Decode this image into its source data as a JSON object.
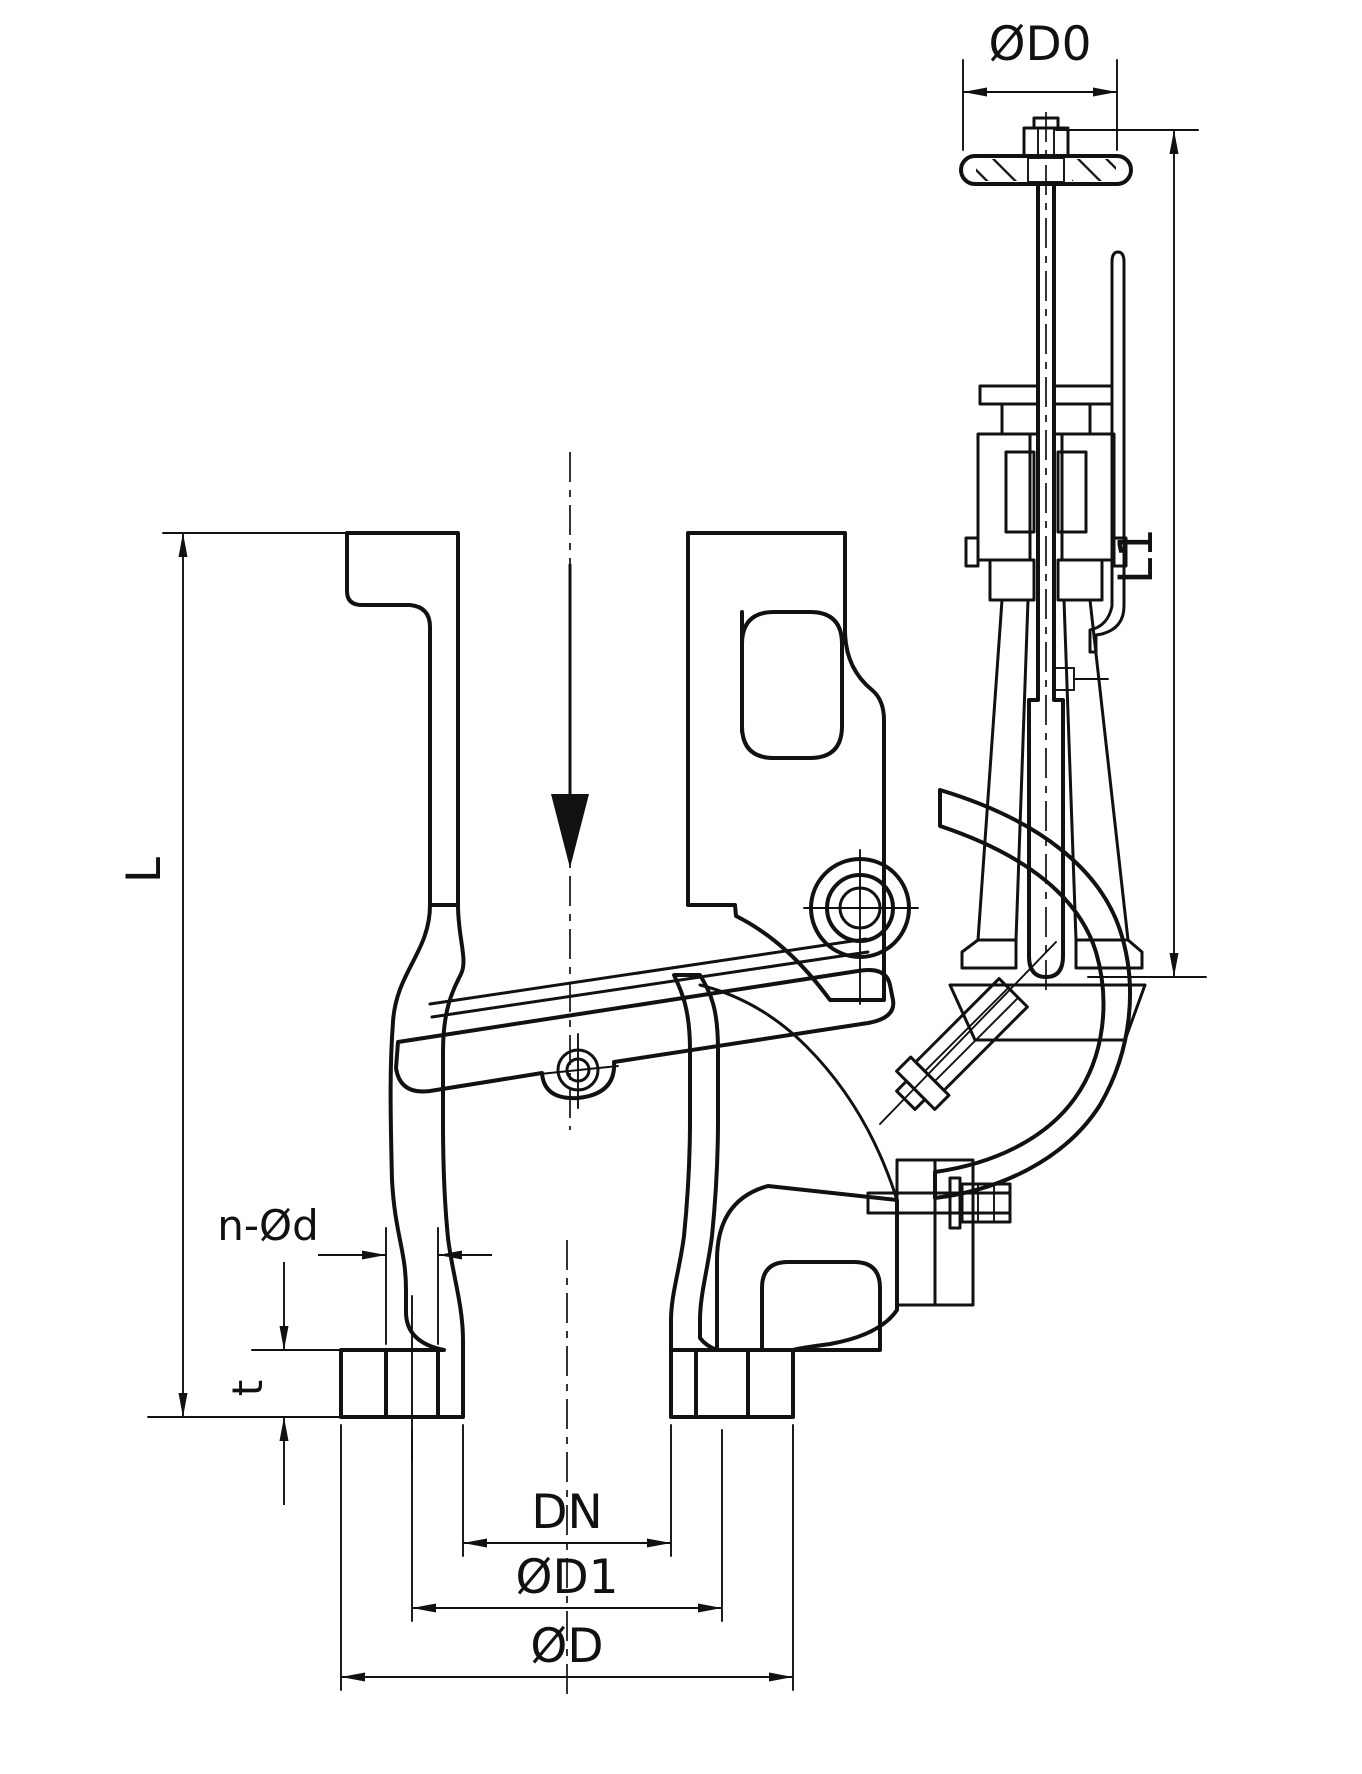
{
  "drawing": {
    "kind": "technical sectional drawing",
    "subject": "flanged screw-down storm valve (angle check valve) with handwheel, cross-section",
    "background": "#ffffff",
    "ink": "#111111"
  },
  "dims": {
    "handwheel_diameter": "ØD0",
    "upper_height": "L1",
    "overall_height": "L",
    "bolt_holes": "n-Ød",
    "flange_thickness": "t",
    "nominal_bore": "DN",
    "bolt_circle_diameter": "ØD1",
    "flange_outer_diameter": "ØD"
  }
}
